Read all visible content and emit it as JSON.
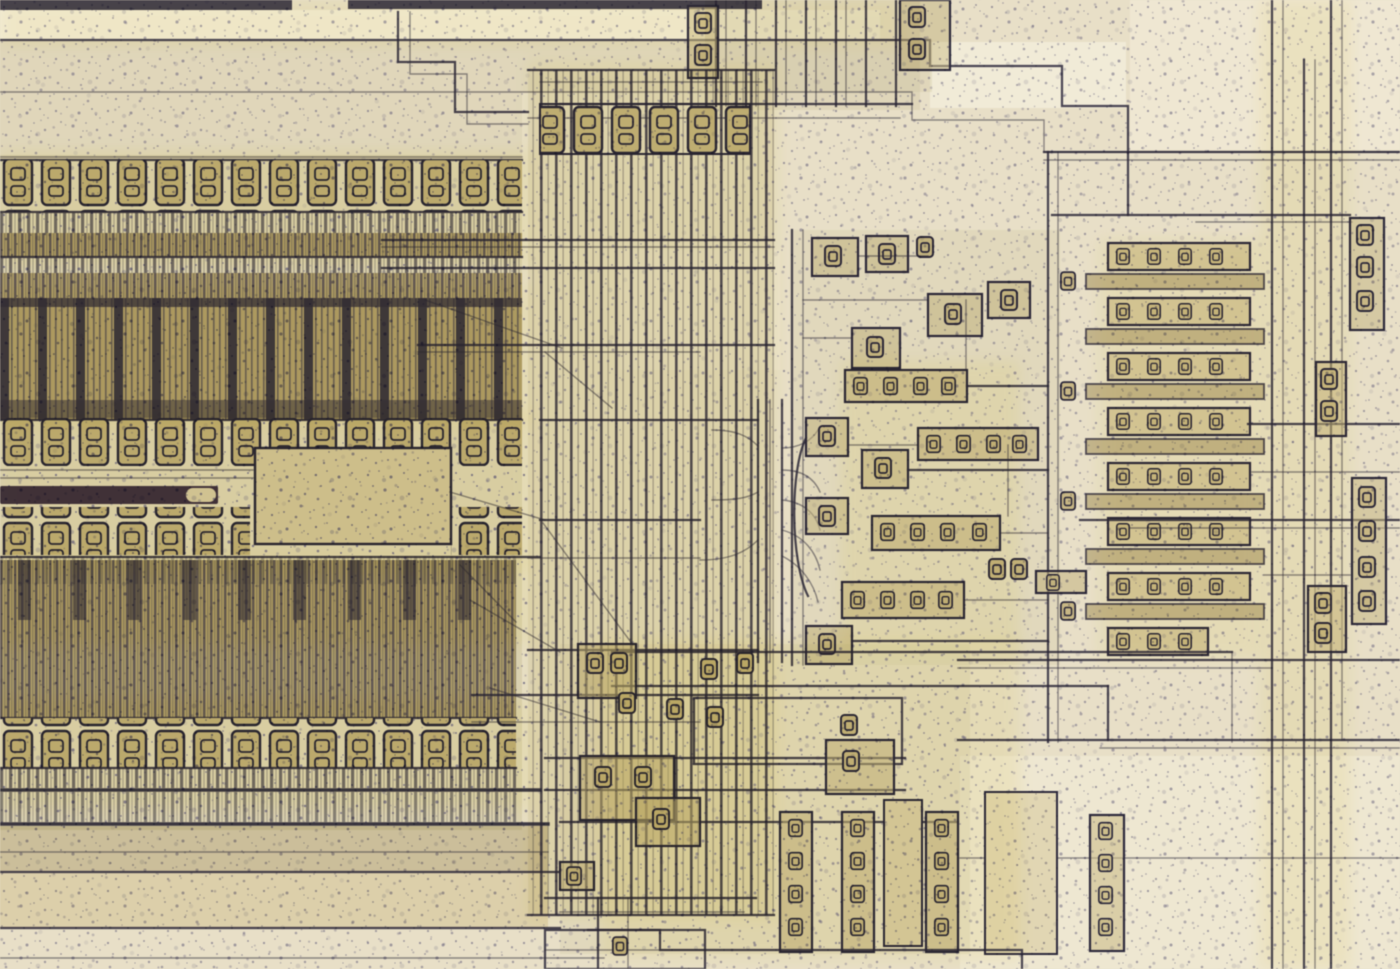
{
  "image": {
    "title": "Integrated circuit die photomicrograph",
    "subject": "Close-up optical microscope photograph of a silicon chip die",
    "aria_label": "Microscope photograph of an integrated circuit die showing dark blue metal interconnect traces, striped transistor gate-finger arrays on the left, a vertical metal bus in the center, clusters of small contact cells on the right, and a speckled beige oxide background",
    "visible_text": "none"
  },
  "palette": {
    "bg": "#e8dfc6",
    "bg-bright": "#f3edd9",
    "tint": "#cdc29d",
    "tint-dark": "#b5a97f",
    "speckle": "#555174",
    "trace": "#2f2d4a",
    "trace-soft": "#6a6590",
    "array-light": "#cbbf94",
    "array-dark": "#3b3752",
    "micro": "#5a5570",
    "pad-fill": "#ddd2a8",
    "purple": "#4c3d57",
    "glint": "#f6f2e4",
    "halo": "#d6bf3e"
  },
  "regions": [
    {
      "name": "left-transistor-array",
      "label": "Transistor gate-finger array with contact ladder rows"
    },
    {
      "name": "purple-metal-trace",
      "label": "Dark purple metal trace with bright glint at its end"
    },
    {
      "name": "vertical-bus",
      "label": "Bundle of parallel vertical metal bus lines"
    },
    {
      "name": "funnel-routing",
      "label": "Curved fan-out routing from bus to logic cells"
    },
    {
      "name": "logic-cluster",
      "label": "Cluster of small logic cells with contact vias"
    },
    {
      "name": "right-contact-bar-stack",
      "label": "Stack of horizontal bars with contact via chains"
    },
    {
      "name": "right-edge-routing",
      "label": "Vertical routing traces and via columns at right edge"
    },
    {
      "name": "bottom-contact-cluster",
      "label": "Bottom cluster of contact strips and boxes"
    },
    {
      "name": "top-routing",
      "label": "Horizontal routing traces with staircase jogs at top"
    }
  ]
}
